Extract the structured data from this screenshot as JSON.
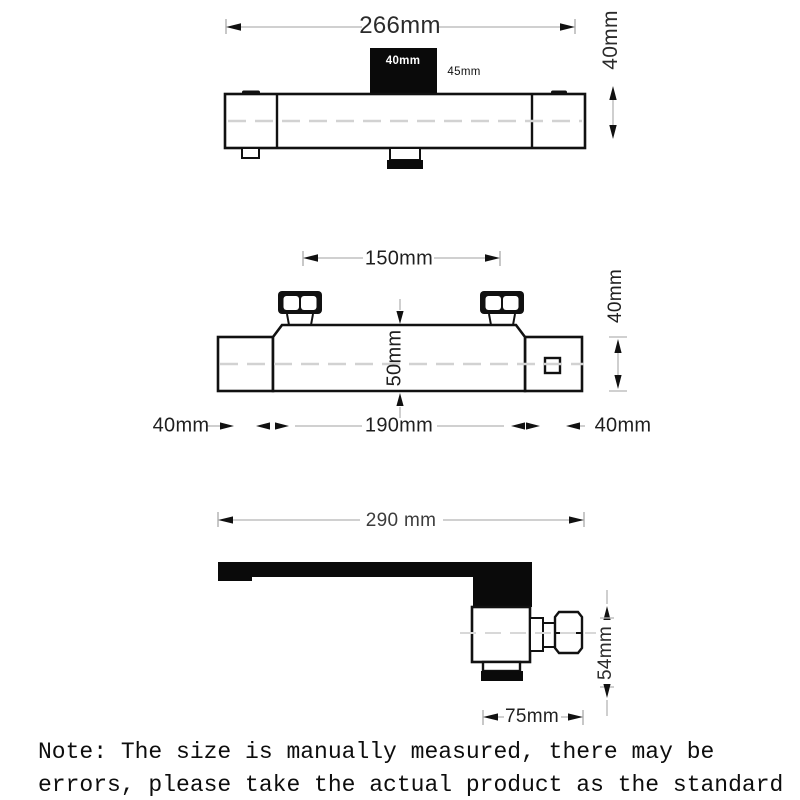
{
  "title": "Thermostatic shower faucet dimension diagram",
  "colors": {
    "background": "#ffffff",
    "outline_black": "#111111",
    "solid_black_fill": "#0a0a0a",
    "dimension_line_gray": "#b5b5b5",
    "centerline_gray": "#d2d2d2",
    "text_dark": "#1f1f1f",
    "handle_label_white": "#ffffff"
  },
  "views": {
    "top": {
      "name": "front view of shower mixer bar",
      "labels": {
        "overall_width": "266mm",
        "bar_height": "40mm",
        "handle_width": "40mm",
        "handle_depth": "45mm"
      }
    },
    "middle": {
      "name": "top view of valve body with inlet nuts",
      "labels": {
        "inlet_spacing": "150mm",
        "end_block_height": "40mm",
        "body_height": "50mm",
        "left_end_width": "40mm",
        "body_width": "190mm",
        "right_end_width": "40mm"
      }
    },
    "bottom": {
      "name": "side view of spout and valve",
      "labels": {
        "spout_reach": "290 mm",
        "valve_height": "54mm",
        "valve_width": "75mm"
      }
    }
  },
  "note": {
    "line1": "Note: The size is manually measured, there may be",
    "line2": "errors, please take the actual product as the standard"
  }
}
